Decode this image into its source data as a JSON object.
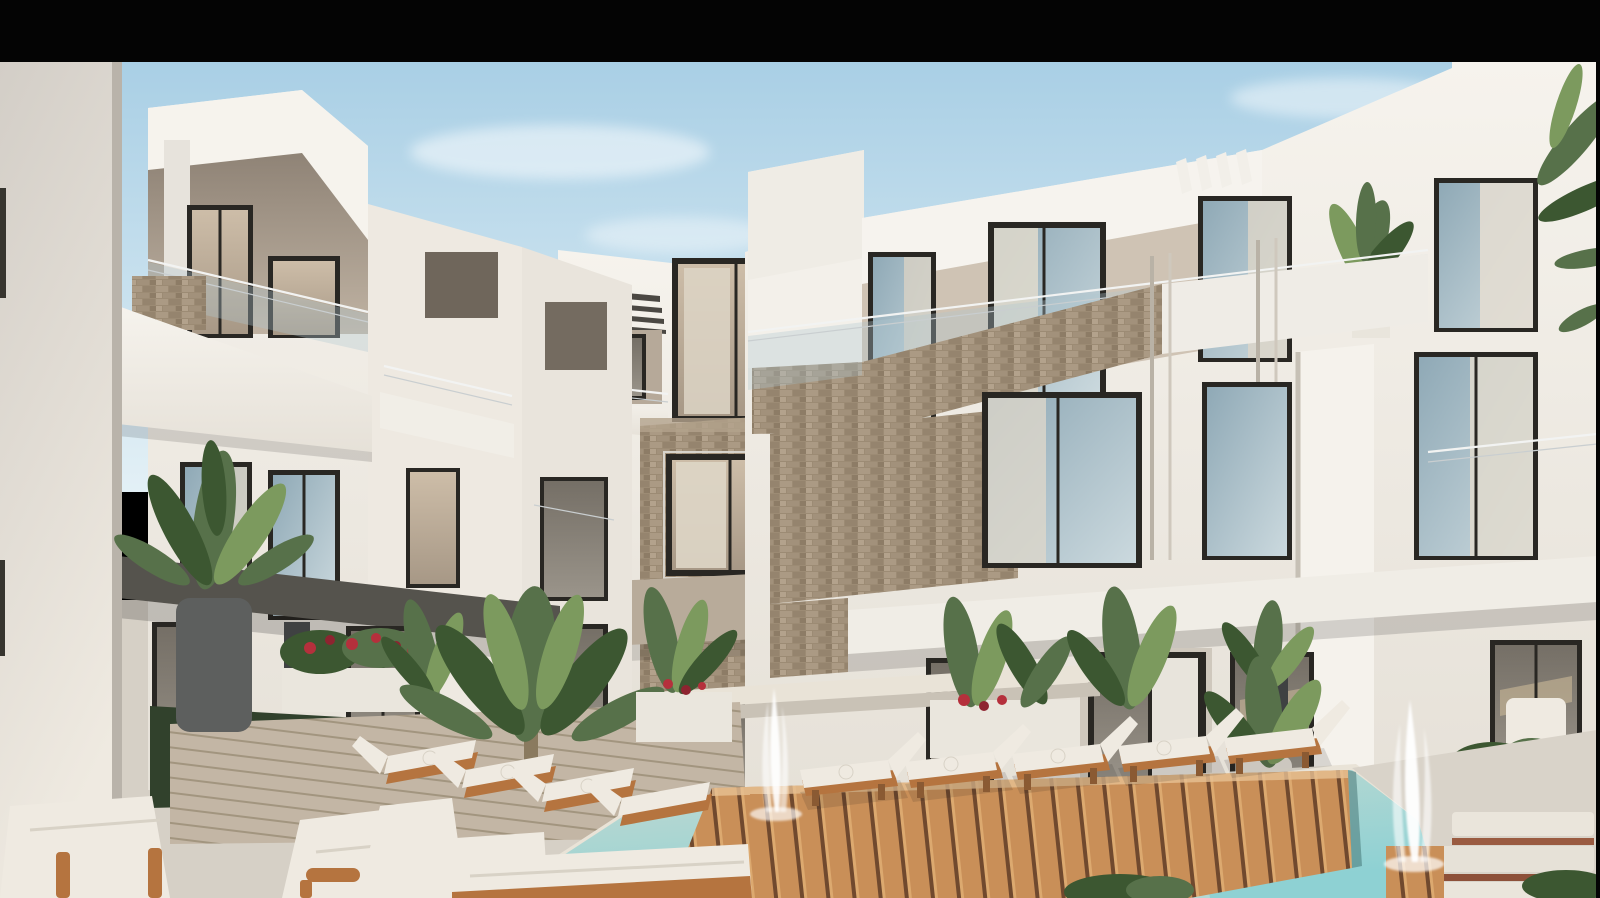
{
  "meta": {
    "kind": "architectural-exterior-render",
    "letterbox": {
      "top_bar_height_px": 62,
      "right_bar_width_px": 4,
      "color": "#040404"
    }
  },
  "scene": {
    "description": "Modern white resort apartment complex courtyard with swimming pool, wooden sun deck, white lounge chairs, tropical plants, stone-clad accents and two water-jet fountains under a clear blue sky",
    "sky": {
      "top": "#a9cfe5",
      "horizon": "#e3f0f6",
      "clouds": "#ffffff"
    },
    "palette": {
      "wall_bright": "#f4f1eb",
      "wall_light": "#eae6de",
      "wall_shade": "#d9d3ca",
      "balcony_shadow": "#b2a595",
      "window_frame": "#292723",
      "glazing_blue": "#9db3bf",
      "glazing_warm": "#c5b6a1",
      "curtain": "#d9d2c4",
      "stone_tan": "#9c8b74",
      "stone_dark": "#32373b",
      "canopy_dark": "#55534d",
      "beam_tan": "#b8ab9a",
      "deck_wood": "#c98f58",
      "deck_gap": "#70492e",
      "paving": "#d6d0c6",
      "plank_gray": "#c3b6a5",
      "pool_near": "#c6dad2",
      "pool_far": "#8ed1d3",
      "leaf_dark": "#3c5731",
      "leaf_mid": "#57714a",
      "leaf_light": "#7c9a5e",
      "flower_red": "#b5303c",
      "cushion": "#efeae1",
      "lounger_frame": "#b5743f",
      "pot_dark": "#5d5f5e",
      "planter_white": "#eae6dd",
      "grass": "#31412c"
    },
    "counts": {
      "fountains": 2,
      "sun_loungers": 12,
      "stories": 3
    }
  }
}
